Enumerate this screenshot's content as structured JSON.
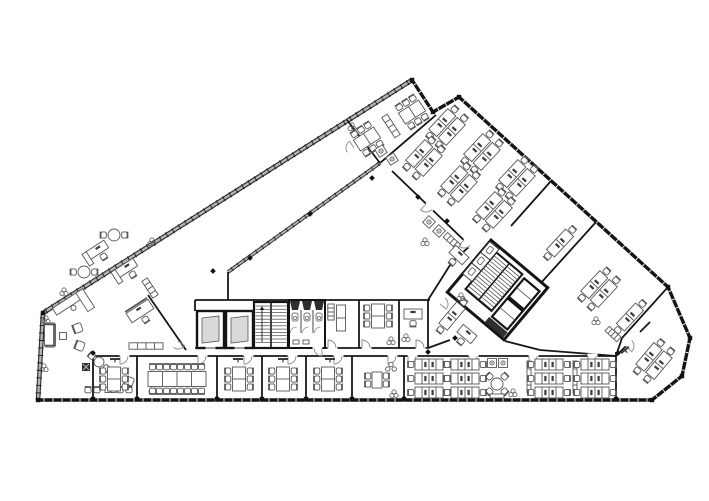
{
  "document": {
    "type": "architectural-floor-plan",
    "description": "Black-and-white office floor plan of a triangular building with two diagonal wings, a bottom wing of meeting rooms and open-plan desks, two service cores, and an empty central courtyard"
  },
  "canvas": {
    "width": 709,
    "height": 501
  },
  "colors": {
    "background": "#ffffff",
    "wall": "#161616",
    "partition": "#222222",
    "furniture": "#555555",
    "furniture_dark": "#3a3a3a",
    "glazing": "#b5b5b5",
    "door": "#8a8a8a",
    "shaft_fill": "#2e2e2e",
    "cab_fill": "#d9d9d9",
    "tread": "#444444"
  },
  "facades": [
    {
      "style": "glass",
      "pts": [
        [
          412,
          80
        ],
        [
          43,
          313
        ],
        [
          38,
          400
        ]
      ]
    },
    {
      "style": "solid",
      "pts": [
        [
          38,
          400
        ],
        [
          652,
          400
        ],
        [
          682,
          376
        ],
        [
          690,
          338
        ],
        [
          668,
          287
        ],
        [
          459,
          97
        ],
        [
          433,
          112
        ],
        [
          412,
          80
        ]
      ]
    }
  ],
  "glass_inner": [
    {
      "pts": [
        [
          228,
          272
        ],
        [
          380,
          163
        ]
      ]
    }
  ],
  "walls": [
    [
      380,
      163,
      436,
      115,
      2
    ],
    [
      347,
      120,
      380,
      163,
      2
    ],
    [
      228,
      272,
      228,
      300,
      2
    ],
    [
      195,
      300,
      430,
      300,
      2
    ],
    [
      195,
      348,
      428,
      348,
      2
    ],
    [
      93,
      356,
      616,
      356,
      2
    ],
    [
      93,
      356,
      93,
      400,
      2
    ],
    [
      137,
      356,
      137,
      400,
      2
    ],
    [
      217,
      356,
      217,
      400,
      2
    ],
    [
      262,
      356,
      262,
      400,
      2
    ],
    [
      306,
      356,
      306,
      400,
      2
    ],
    [
      352,
      356,
      352,
      400,
      2
    ],
    [
      404,
      356,
      404,
      400,
      2
    ],
    [
      616,
      352,
      616,
      400,
      2
    ],
    [
      289,
      300,
      289,
      348,
      2
    ],
    [
      325,
      300,
      325,
      348,
      2
    ],
    [
      359,
      300,
      359,
      348,
      2
    ],
    [
      399,
      300,
      399,
      348,
      2
    ],
    [
      428,
      300,
      428,
      348,
      2
    ],
    [
      148,
      295,
      186,
      350,
      2
    ],
    [
      428,
      300,
      452,
      262,
      2
    ],
    [
      452,
      262,
      470,
      246,
      2
    ],
    [
      392,
      171,
      470,
      246,
      2
    ],
    [
      551,
      181,
      511,
      226,
      2
    ],
    [
      596,
      222,
      540,
      284,
      2
    ],
    [
      668,
      287,
      622,
      338,
      2
    ],
    [
      622,
      338,
      616,
      356,
      2
    ],
    [
      616,
      356,
      626,
      346,
      2
    ],
    [
      640,
      332,
      650,
      322,
      2
    ],
    [
      428,
      348,
      450,
      340,
      2
    ],
    [
      505,
      341,
      540,
      350,
      2
    ],
    [
      540,
      350,
      616,
      356,
      2
    ],
    [
      195,
      300,
      195,
      311,
      2
    ]
  ],
  "doors": [
    [
      120,
      356,
      0,
      1
    ],
    [
      198,
      356,
      0,
      1
    ],
    [
      244,
      356,
      0,
      1
    ],
    [
      288,
      356,
      0,
      1
    ],
    [
      334,
      356,
      0,
      1
    ],
    [
      388,
      356,
      0,
      1
    ],
    [
      408,
      356,
      0,
      1
    ],
    [
      469,
      356,
      0,
      1
    ],
    [
      529,
      356,
      0,
      1
    ],
    [
      588,
      356,
      0,
      1
    ],
    [
      626,
      346,
      -45,
      1
    ],
    [
      328,
      348,
      0,
      -1
    ],
    [
      362,
      348,
      0,
      -1
    ],
    [
      416,
      348,
      0,
      -1
    ],
    [
      322,
      348,
      180,
      -1
    ],
    [
      354,
      148,
      147,
      1
    ],
    [
      426,
      204,
      43,
      1
    ],
    [
      464,
      240,
      43,
      1
    ],
    [
      178,
      341,
      125,
      -1
    ],
    [
      440,
      304,
      -50,
      1
    ]
  ],
  "cores": {
    "central": {
      "elevators": [
        [
          197,
          311,
          27,
          37
        ],
        [
          226,
          311,
          27,
          37
        ]
      ],
      "stair": [
        254,
        302,
        34,
        46
      ],
      "wc": [
        289,
        300,
        36,
        48
      ]
    },
    "right": {
      "cx": 499,
      "cy": 299,
      "rot": 40
    }
  },
  "bench_grid": {
    "cols": [
      429,
      465,
      549,
      595
    ],
    "rows": [
      364.5,
      378.5,
      392.5
    ]
  },
  "furniture": [
    [
      "table6",
      367,
      139,
      -33
    ],
    [
      "table6",
      412,
      112,
      -33
    ],
    [
      "copier",
      381,
      151,
      -33
    ],
    [
      "copier",
      392,
      159,
      -33
    ],
    [
      "shelf",
      391,
      126,
      57,
      {
        "w": 24
      }
    ],
    [
      "plant",
      352,
      127,
      0
    ],
    [
      "deskret",
      97,
      250,
      -33
    ],
    [
      "deskret",
      126,
      268,
      -33
    ],
    [
      "round3",
      84,
      272,
      0,
      {
        "r": 6
      }
    ],
    [
      "round3",
      114,
      235,
      0,
      {
        "r": 6
      }
    ],
    [
      "workdesk",
      140,
      311,
      -33
    ],
    [
      "shelf",
      150,
      288,
      57,
      {
        "w": 20
      }
    ],
    [
      "plant",
      64,
      292,
      0
    ],
    [
      "plant",
      152,
      242,
      0
    ],
    [
      "recep",
      68,
      303,
      -33
    ],
    [
      "sofa",
      50,
      335,
      90,
      {
        "w": 24
      }
    ],
    [
      "coffee",
      63,
      336,
      0
    ],
    [
      "armchair",
      78,
      328,
      -110
    ],
    [
      "armchair",
      80,
      346,
      -70
    ],
    [
      "plant",
      46,
      320,
      0
    ],
    [
      "shelf",
      146,
      346,
      0,
      {
        "w": 34
      }
    ],
    [
      "round3",
      99,
      362,
      40,
      {
        "r": 5
      }
    ],
    [
      "armchair",
      113,
      374,
      160
    ],
    [
      "armchair",
      129,
      381,
      200
    ],
    [
      "darkbox",
      86,
      367,
      0
    ],
    [
      "darkbox",
      183,
      378,
      0
    ],
    [
      "waitrow",
      108,
      390,
      0
    ],
    [
      "plant",
      153,
      390,
      0
    ],
    [
      "plant",
      44,
      368,
      0
    ],
    [
      "tall",
      341,
      318,
      0
    ],
    [
      "shelf",
      331,
      312,
      90,
      {
        "w": 16
      }
    ],
    [
      "table6v",
      378,
      316,
      0
    ],
    [
      "plant",
      391,
      341,
      0
    ],
    [
      "desksingle",
      413,
      314,
      0
    ],
    [
      "plant",
      406,
      338,
      0
    ],
    [
      "cluster",
      452,
      316,
      40,
      {
        "cols": 1
      }
    ],
    [
      "desksingle",
      467,
      334,
      40
    ],
    [
      "plant",
      461,
      297,
      0
    ],
    [
      "cluster",
      447,
      127,
      43
    ],
    [
      "cluster",
      482,
      152,
      43
    ],
    [
      "cluster",
      517,
      178,
      43
    ],
    [
      "cluster",
      424,
      158,
      43
    ],
    [
      "cluster",
      459,
      184,
      43
    ],
    [
      "cluster",
      494,
      210,
      43
    ],
    [
      "copier",
      429,
      222,
      43
    ],
    [
      "copier",
      439,
      231,
      43
    ],
    [
      "shelf",
      452,
      241,
      43,
      {
        "w": 18
      }
    ],
    [
      "plant",
      425,
      242,
      0
    ],
    [
      "desksingle",
      459,
      255,
      43
    ],
    [
      "cluster",
      560,
      243,
      43,
      {
        "cols": 1
      }
    ],
    [
      "cluster",
      599,
      289,
      43
    ],
    [
      "cluster",
      630,
      317,
      43,
      {
        "cols": 1
      }
    ],
    [
      "shelf",
      613,
      334,
      43,
      {
        "w": 16
      }
    ],
    [
      "plant",
      596,
      321,
      0
    ],
    [
      "cluster",
      654,
      361,
      40
    ],
    [
      "tv",
      625,
      350,
      -40
    ],
    [
      "table6v",
      114,
      379,
      0
    ],
    [
      "conf",
      177,
      379,
      0
    ],
    [
      "table6v",
      239,
      379,
      0
    ],
    [
      "table6v",
      283,
      379,
      0
    ],
    [
      "table6v",
      328,
      379,
      0
    ],
    [
      "small4",
      377,
      380,
      0
    ],
    [
      "stools",
      391,
      367,
      0
    ],
    [
      "plant",
      394,
      394,
      0
    ],
    [
      "tv",
      115,
      359,
      0
    ],
    [
      "tv",
      238,
      359,
      0
    ],
    [
      "tv",
      283,
      359,
      0
    ],
    [
      "tv",
      330,
      359,
      0
    ],
    [
      "copier",
      492,
      363,
      0
    ],
    [
      "copier",
      503,
      363,
      0
    ],
    [
      "round4",
      497,
      384,
      45,
      {
        "r": 6
      }
    ],
    [
      "benchseat",
      497,
      396,
      0
    ],
    [
      "plant",
      513,
      393,
      0
    ],
    [
      "locker",
      529,
      377,
      0
    ],
    [
      "locker",
      575,
      377,
      0
    ]
  ],
  "diamonds": [
    [
      213,
      271
    ],
    [
      250,
      258
    ],
    [
      310,
      214
    ],
    [
      372,
      178
    ],
    [
      418,
      197
    ],
    [
      447,
      221
    ],
    [
      93,
      353
    ],
    [
      428,
      352
    ],
    [
      455,
      338
    ],
    [
      618,
      353
    ]
  ],
  "piers": [
    [
      93,
      399
    ],
    [
      137,
      399
    ],
    [
      217,
      399
    ],
    [
      262,
      399
    ],
    [
      306,
      399
    ],
    [
      352,
      399
    ],
    [
      404,
      399
    ],
    [
      616,
      399
    ],
    [
      668,
      287
    ],
    [
      690,
      338
    ],
    [
      682,
      376
    ],
    [
      652,
      400
    ],
    [
      38,
      400
    ],
    [
      43,
      313
    ],
    [
      412,
      80
    ],
    [
      459,
      97
    ],
    [
      433,
      112
    ]
  ]
}
